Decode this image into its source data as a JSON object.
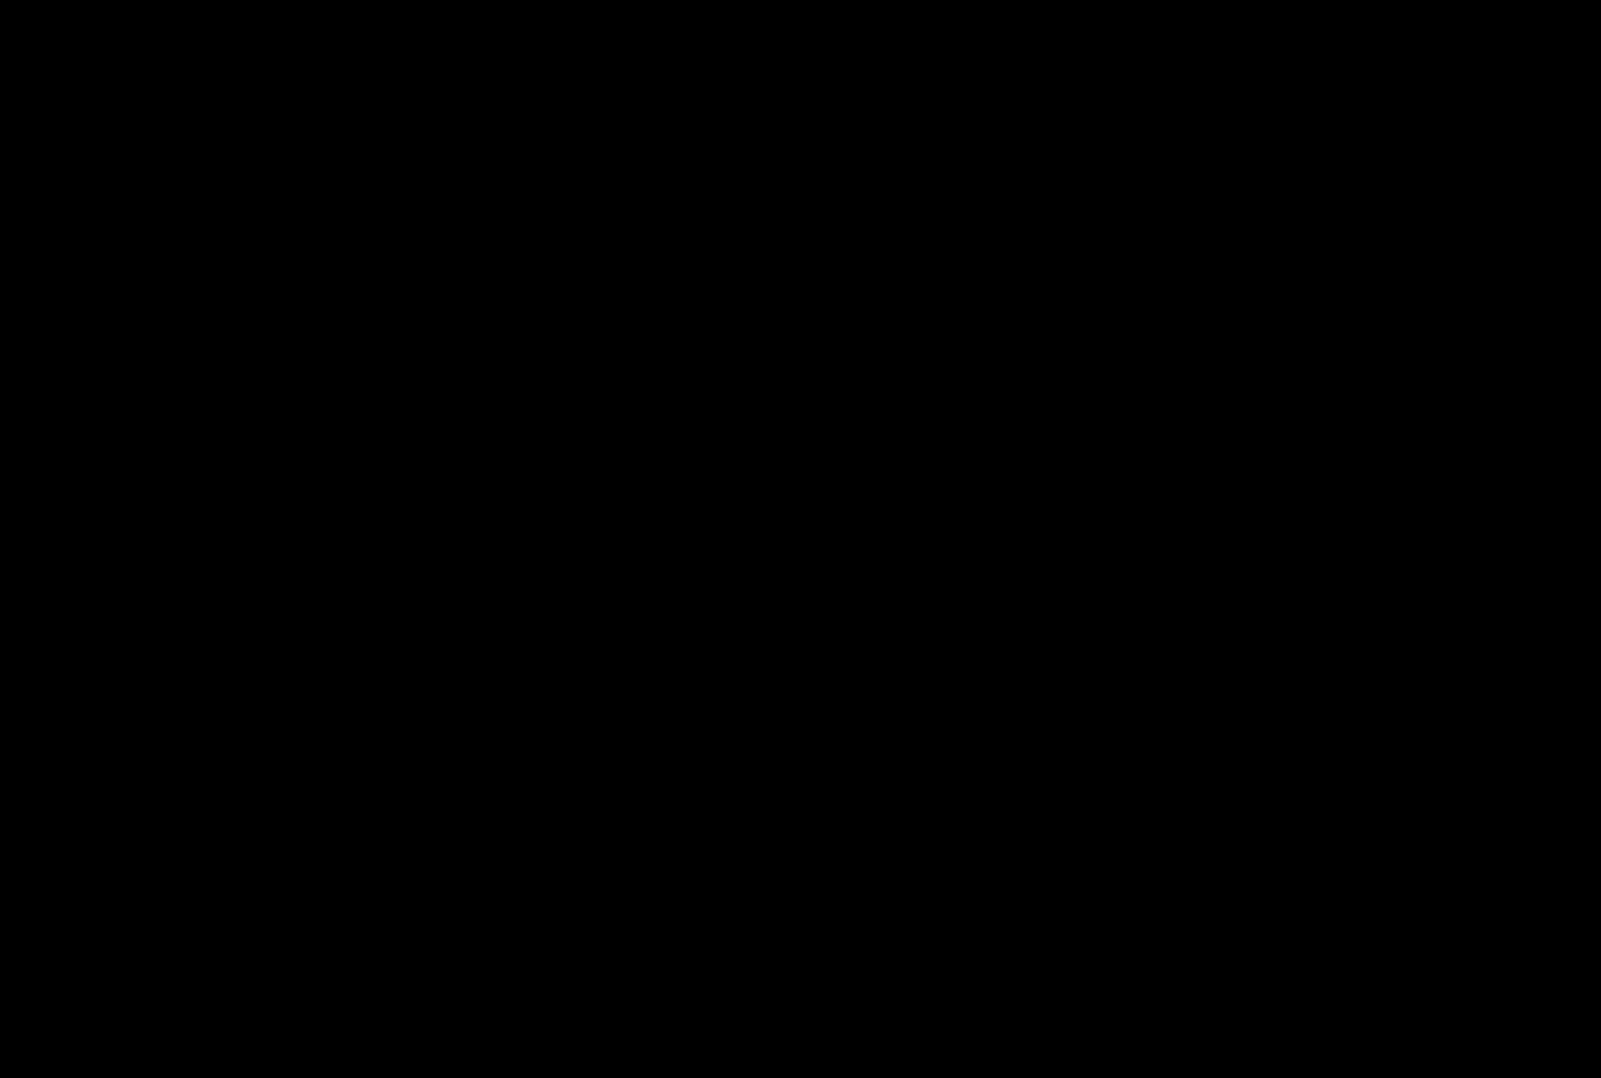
{
  "scene": {
    "title": "Isometric illustration of a horse racecourse facility",
    "background": "#000000",
    "palette": {
      "road": "#ffffff",
      "ground": "#ddeaf8",
      "path": "#ead9bd",
      "track": "#e6d6b6",
      "trackLine": "#d2bd93",
      "infield": "#d7eed5",
      "tree": "#cde9c5",
      "hedge": "#c5e6bd",
      "bush": "#e8f4e3",
      "building": "#ffffff",
      "roof": "#dfd9f2",
      "outline": "#4c4c4c",
      "silhouette": "#8f8f8f",
      "paddockPink": "#f9d6d6",
      "screenDark": "#4f4f4f",
      "poleRed": "#e25353",
      "flagYellow": "#f2e087",
      "flagWhite": "#ffffff",
      "glass": "#fbfdff"
    },
    "inventory": {
      "city_buildings": 4,
      "stable_blocks": 14,
      "grandstands": 2,
      "paddock_horses": 4,
      "race_horses": 8,
      "marker_poles": 4,
      "floodlights": 4,
      "starting_gate_stalls": 6,
      "vehicles": [
        "minibus",
        "ambulance"
      ],
      "flags": [
        {
          "holder": "track-official",
          "color": "#f2e087"
        },
        {
          "holder": "infield-official",
          "color": "#ffffff"
        }
      ]
    },
    "areas": [
      {
        "name": "city-block"
      },
      {
        "name": "perimeter-road"
      },
      {
        "name": "entrance-arch"
      },
      {
        "name": "stable-rows"
      },
      {
        "name": "paddock"
      },
      {
        "name": "video-board"
      },
      {
        "name": "grandstand-a"
      },
      {
        "name": "grandstand-b"
      },
      {
        "name": "main-track"
      },
      {
        "name": "infield"
      },
      {
        "name": "starting-gate"
      },
      {
        "name": "winning-post"
      },
      {
        "name": "office-towers"
      },
      {
        "name": "betting-hall"
      },
      {
        "name": "parking-area"
      }
    ]
  }
}
